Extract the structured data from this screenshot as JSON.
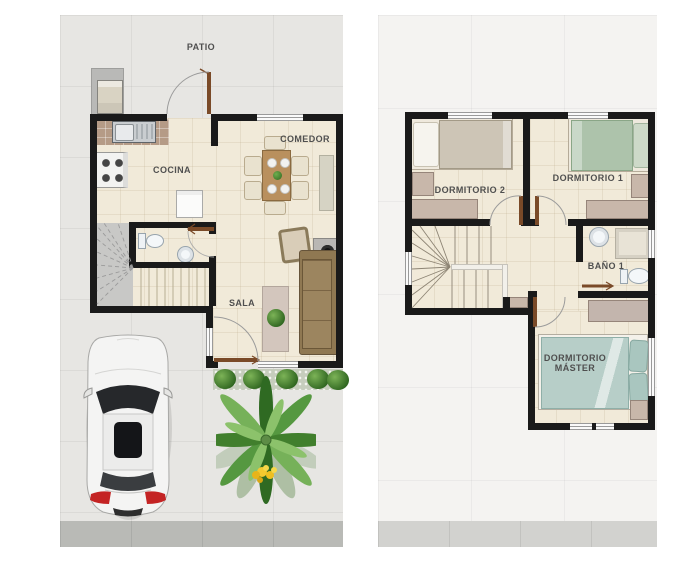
{
  "ground_floor": {
    "labels": {
      "patio": "PATIO",
      "cocina": "COCINA",
      "comedor": "COMEDOR",
      "sala": "SALA"
    }
  },
  "upper_floor": {
    "labels": {
      "dormitorio_2": "DORMITORIO 2",
      "dormitorio_1": "DORMITORIO 1",
      "bano_1": "BAÑO 1",
      "master_line_1": "DORMITORIO",
      "master_line_2": "MÁSTER"
    }
  },
  "colors": {
    "wall": "#1a1a1a",
    "floor_tile": "#f1ead9",
    "ground_lot": "#e7e6e3",
    "upper_lot": "#f4f3f1",
    "sidewalk_ground": "#b9bab6",
    "sidewalk_upper": "#d2d2cf",
    "door_leaf": "#7a4a28",
    "sofa": "#8f7852",
    "master_bed": "#b7cec8",
    "dorm1_bed": "#adc3ab",
    "dorm2_bed": "#cdc5b6",
    "hedge_green": "#3c7227",
    "car_body": "#f4f4f3",
    "palm_green": "#559840",
    "label_text": "#4f4f4f"
  }
}
